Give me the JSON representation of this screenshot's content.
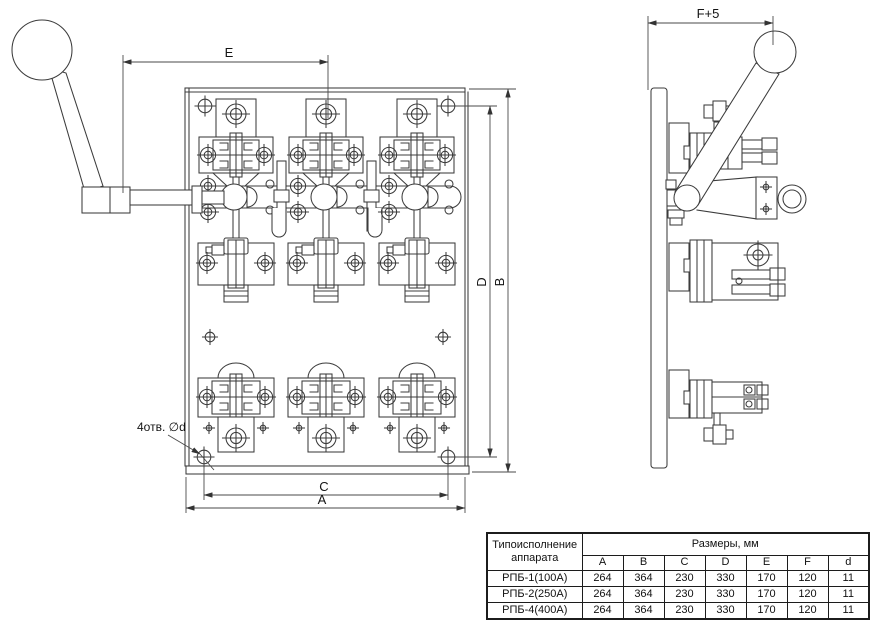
{
  "sheet": {
    "background": "#ffffff",
    "line_color": "#3c3c3c"
  },
  "front_view": {
    "dims": {
      "E": "E",
      "B": "B",
      "D": "D",
      "C": "C",
      "A": "A"
    },
    "holes_note": "4отв. ∅d"
  },
  "side_view": {
    "dims": {
      "F": "F+5"
    }
  },
  "spec_table": {
    "type_header": "Типоисполнение аппарата",
    "dims_header": "Размеры, мм",
    "columns": [
      "A",
      "B",
      "C",
      "D",
      "E",
      "F",
      "d"
    ],
    "rows": [
      {
        "type": "РПБ-1(100А)",
        "values": [
          "264",
          "364",
          "230",
          "330",
          "170",
          "120",
          "11"
        ]
      },
      {
        "type": "РПБ-2(250А)",
        "values": [
          "264",
          "364",
          "230",
          "330",
          "170",
          "120",
          "11"
        ]
      },
      {
        "type": "РПБ-4(400А)",
        "values": [
          "264",
          "364",
          "230",
          "330",
          "170",
          "120",
          "11"
        ]
      }
    ]
  }
}
